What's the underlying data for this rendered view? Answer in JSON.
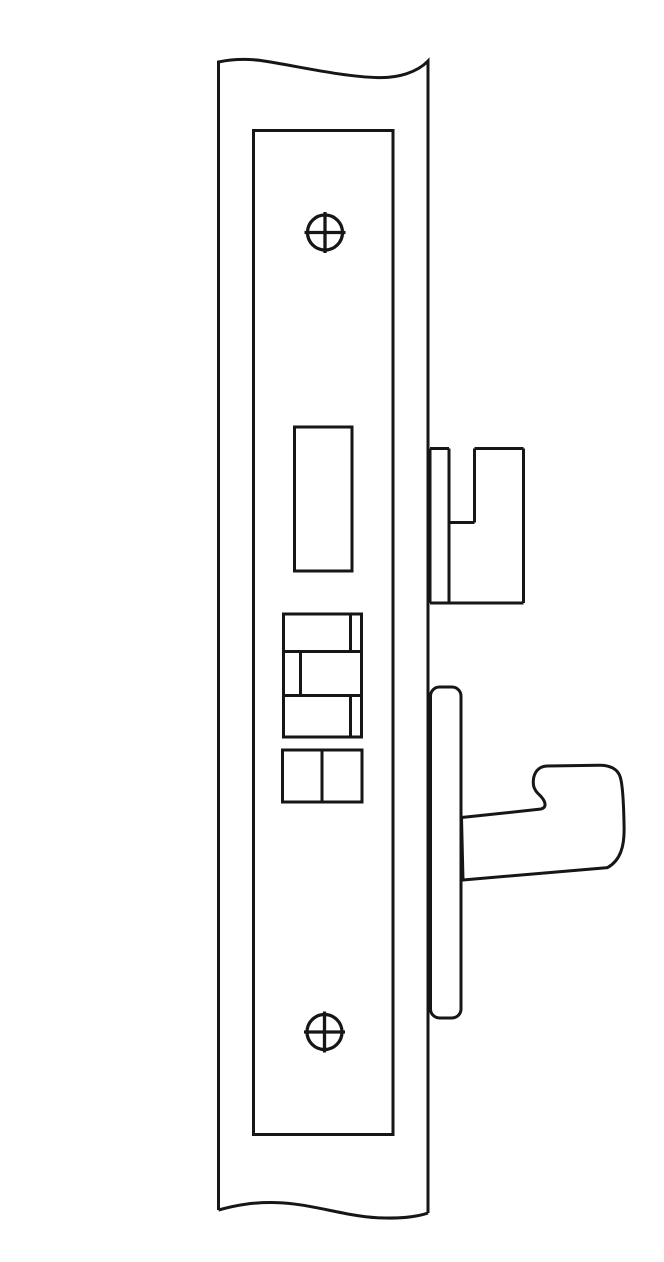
{
  "canvas": {
    "width": 664,
    "height": 1230
  },
  "colors": {
    "line": "#161616",
    "background": "#ffffff"
  },
  "stroke": {
    "main_width": "3",
    "screw_width": "3.3"
  },
  "components": [
    "door-stile-break-line-drawing",
    "faceplate",
    "mounting-screw-top",
    "latch-opening",
    "bolt-stack",
    "spacer-block",
    "latchbolt-profile",
    "armored-front-strip",
    "hook-bolt",
    "mounting-screw-bottom"
  ]
}
